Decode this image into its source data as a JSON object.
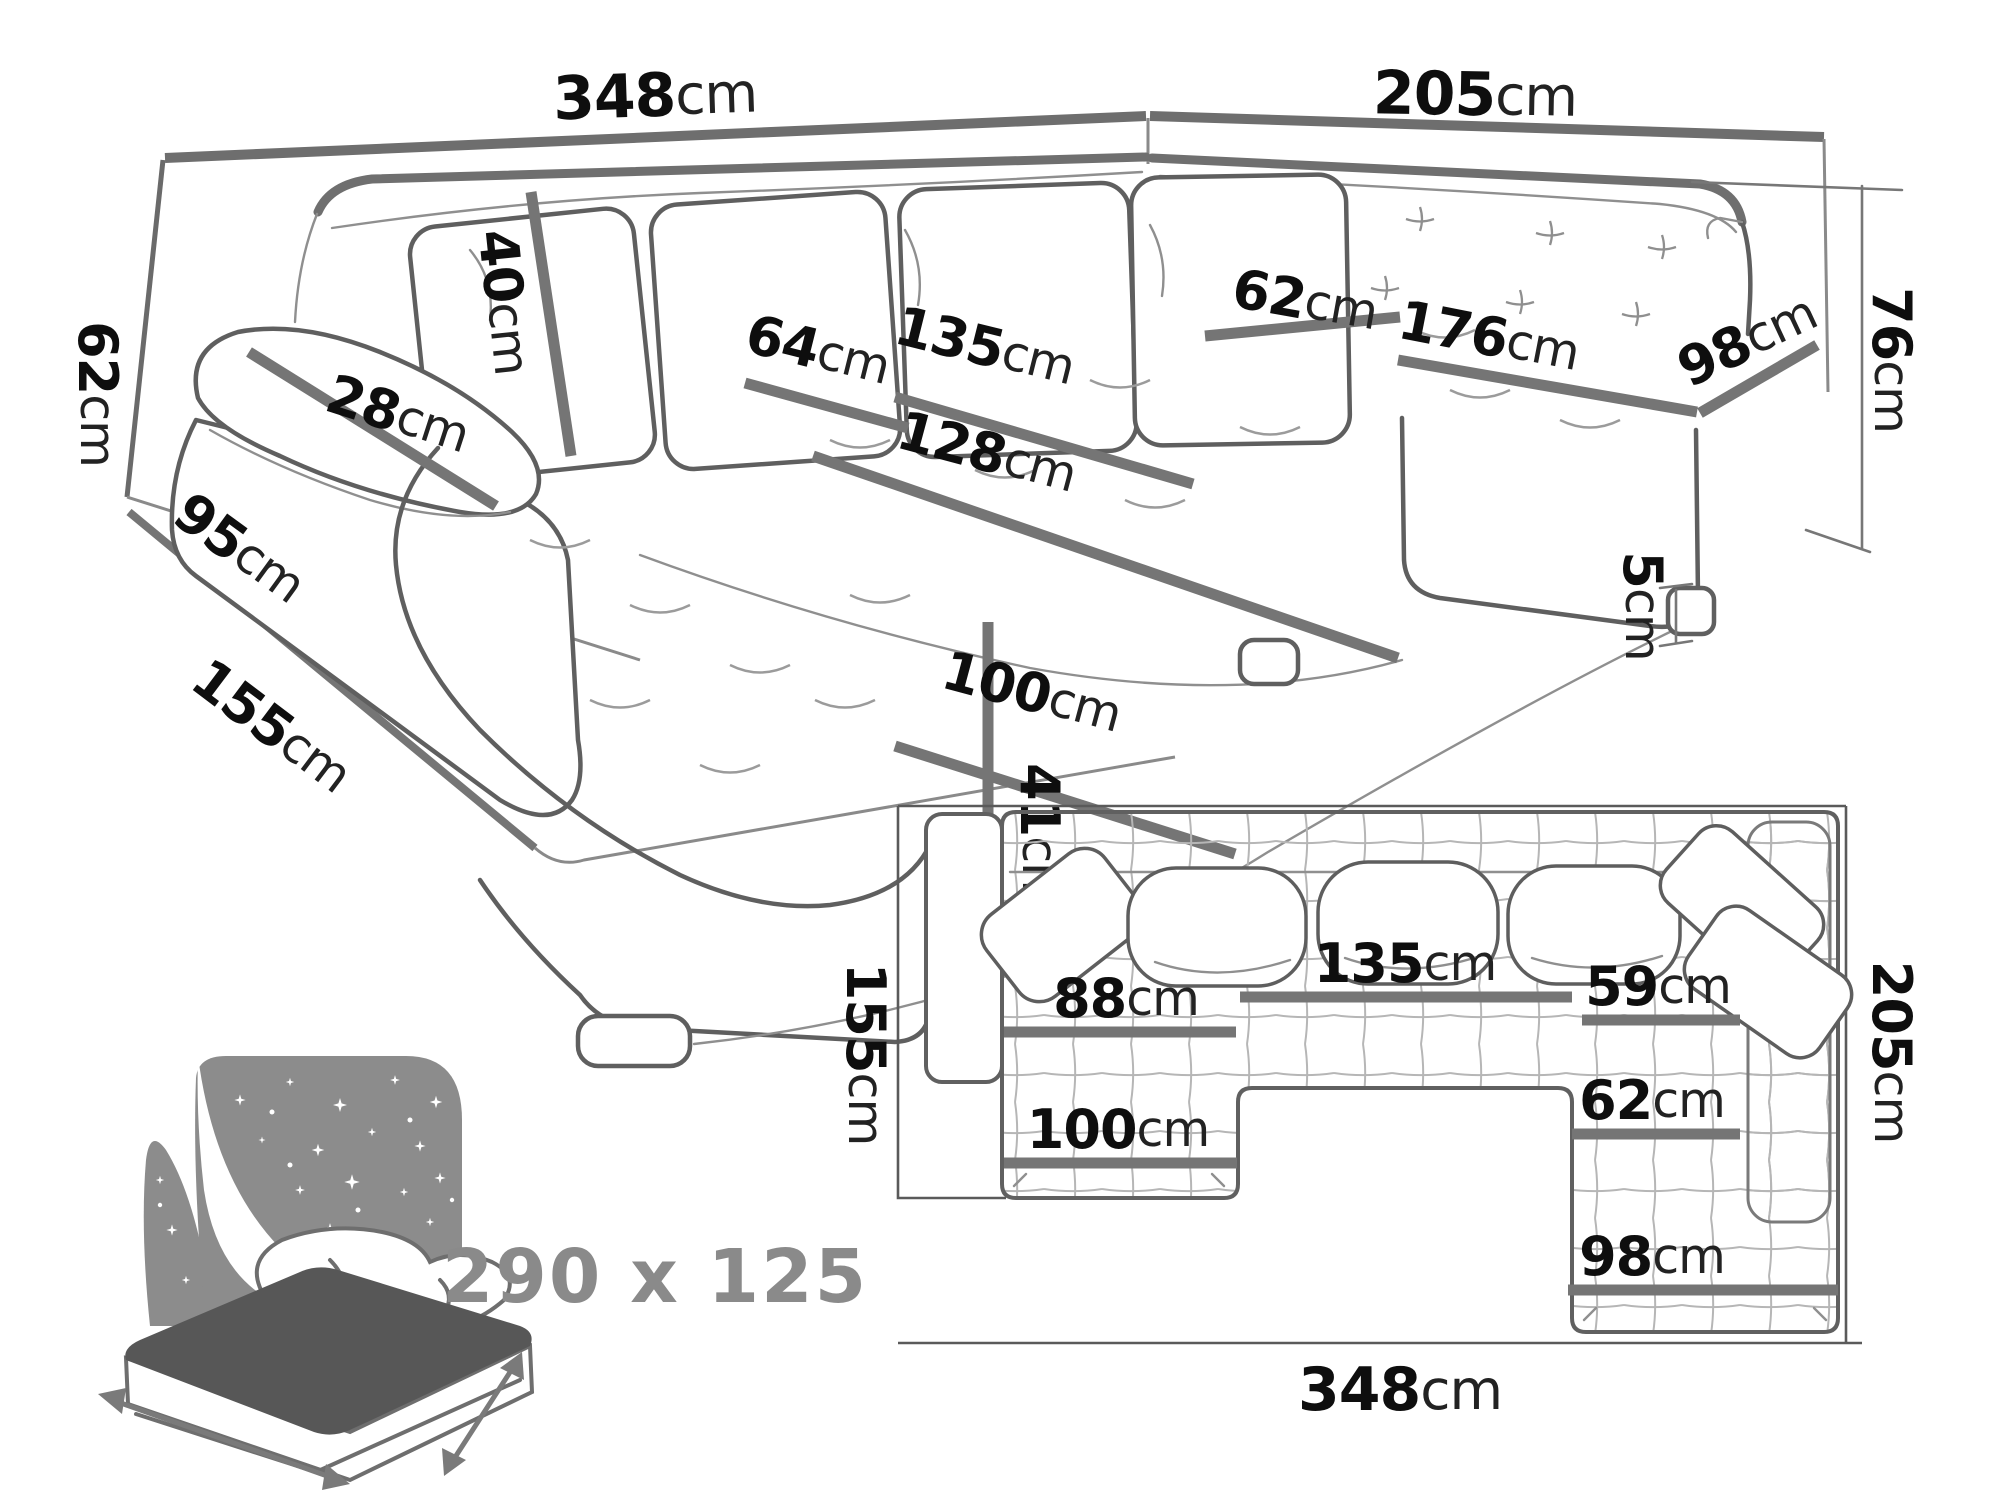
{
  "diagram": {
    "type": "sofa-dimension-diagram",
    "views": [
      "perspective",
      "floor-plan",
      "sleeping-function"
    ],
    "colors": {
      "background": "#ffffff",
      "label_text": "#0e0e0e",
      "dimension_bar": "#757575",
      "sofa_outline": "#5f5f5f",
      "icon_gray": "#8c8c8c",
      "mattress_top": "#575757"
    }
  },
  "persp": {
    "back_width": {
      "num": "348",
      "unit": "cm"
    },
    "right_width": {
      "num": "205",
      "unit": "cm"
    },
    "cushion_height": {
      "num": "40",
      "unit": "cm"
    },
    "headrest_width": {
      "num": "28",
      "unit": "cm"
    },
    "seat_depth": {
      "num": "64",
      "unit": "cm"
    },
    "middle_width": {
      "num": "135",
      "unit": "cm"
    },
    "chaise_length": {
      "num": "128",
      "unit": "cm"
    },
    "corner_depth": {
      "num": "62",
      "unit": "cm"
    },
    "right_length": {
      "num": "176",
      "unit": "cm"
    },
    "right_end_width": {
      "num": "98",
      "unit": "cm"
    },
    "back_height": {
      "num": "76",
      "unit": "cm"
    },
    "leg_height": {
      "num": "5",
      "unit": "cm"
    },
    "arm_height": {
      "num": "62",
      "unit": "cm"
    },
    "base_depth": {
      "num": "95",
      "unit": "cm"
    },
    "floor_depth": {
      "num": "155",
      "unit": "cm"
    },
    "chaise_width": {
      "num": "100",
      "unit": "cm"
    },
    "seat_height": {
      "num": "41",
      "unit": "cm"
    }
  },
  "plan": {
    "depth_left": {
      "num": "155",
      "unit": "cm"
    },
    "middle_width": {
      "num": "135",
      "unit": "cm"
    },
    "left_seat_width": {
      "num": "88",
      "unit": "cm"
    },
    "right_seat_width": {
      "num": "59",
      "unit": "cm"
    },
    "right_seat_depth": {
      "num": "62",
      "unit": "cm"
    },
    "chaise_width": {
      "num": "100",
      "unit": "cm"
    },
    "right_end_width": {
      "num": "98",
      "unit": "cm"
    },
    "total_depth": {
      "num": "205",
      "unit": "cm"
    },
    "total_width": {
      "num": "348",
      "unit": "cm"
    }
  },
  "sleeping": {
    "label": "290 x 125"
  }
}
